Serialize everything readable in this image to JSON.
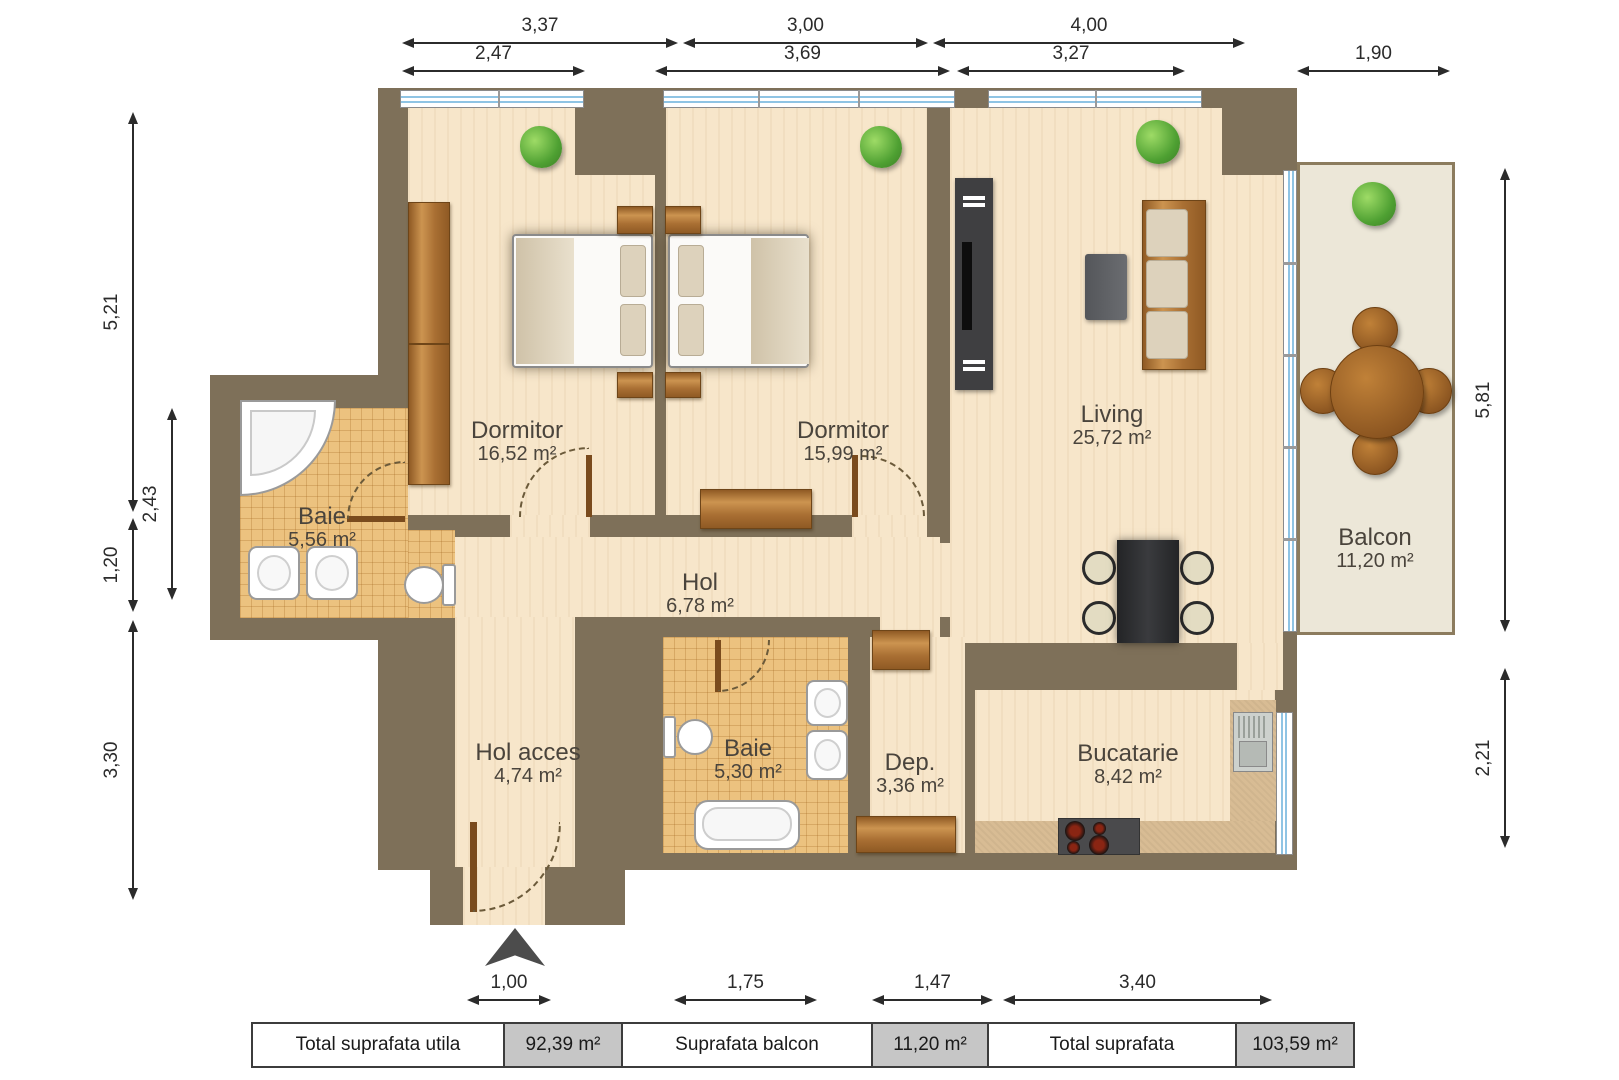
{
  "rooms": [
    {
      "id": "dormitor1",
      "name": "Dormitor",
      "area": "16,52 m²"
    },
    {
      "id": "dormitor2",
      "name": "Dormitor",
      "area": "15,99 m²"
    },
    {
      "id": "living",
      "name": "Living",
      "area": "25,72 m²"
    },
    {
      "id": "baie1",
      "name": "Baie",
      "area": "5,56 m²"
    },
    {
      "id": "hol",
      "name": "Hol",
      "area": "6,78 m²"
    },
    {
      "id": "hol_acces",
      "name": "Hol acces",
      "area": "4,74 m²"
    },
    {
      "id": "baie2",
      "name": "Baie",
      "area": "5,30 m²"
    },
    {
      "id": "dep",
      "name": "Dep.",
      "area": "3,36 m²"
    },
    {
      "id": "bucatarie",
      "name": "Bucatarie",
      "area": "8,42 m²"
    },
    {
      "id": "balcon",
      "name": "Balcon",
      "area": "11,20 m²"
    }
  ],
  "dimensions": {
    "top_row1": [
      "3,37",
      "3,00",
      "4,00"
    ],
    "top_row2": [
      "2,47",
      "3,69",
      "3,27",
      "1,90"
    ],
    "left": [
      "5,21",
      "2,43",
      "1,20",
      "3,30"
    ],
    "right": [
      "5,81",
      "2,21"
    ],
    "bottom": [
      "1,00",
      "1,75",
      "1,47",
      "3,40"
    ]
  },
  "summary_table": [
    {
      "label": "Total suprafata utila",
      "value": "92,39 m²"
    },
    {
      "label": "Suprafata balcon",
      "value": "11,20 m²"
    },
    {
      "label": "Total suprafata",
      "value": "103,59 m²"
    }
  ],
  "colors": {
    "wall": "#7e7059",
    "wood_floor": "#f7e6ca",
    "tile_floor": "#ecc27f",
    "balcony_floor": "#ece7d8",
    "counter": "#d8bc94",
    "window_blue": "#8fc4e4",
    "dim_text": "#2b2b2b",
    "label_text": "#4a443c",
    "table_value_bg": "#c6c6c6"
  }
}
